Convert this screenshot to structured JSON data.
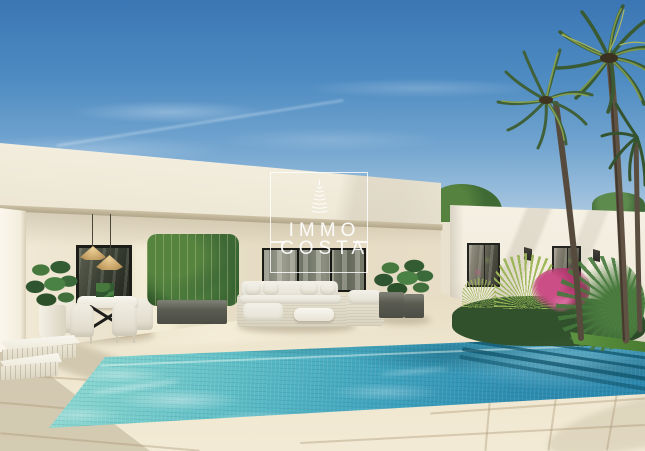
{
  "scene": {
    "setting": "3D architectural render: modern white single-storey villa with covered terrace, turquoise mosaic swimming pool, palm trees and blue sky",
    "elements": [
      "sky",
      "main-villa-fascia",
      "covered-terrace",
      "right-wing",
      "dining-set",
      "pendant-lamps",
      "outdoor-sofa",
      "bamboo-planter",
      "monstera-plant",
      "sun-loungers",
      "swimming-pool",
      "pool-steps",
      "palm-trees",
      "bougainvillea",
      "lawn",
      "stone-deck",
      "watermark"
    ]
  },
  "watermark": {
    "icon": "tower-logo-icon",
    "line1": "IMMO",
    "line2": "COSTA"
  },
  "colors": {
    "sky_top": "#3b76b4",
    "sky_horizon": "#cfdfeb",
    "facade_cream": "#f3eee1",
    "deck_beige": "#ecdfc6",
    "pool_light": "#8ed8d0",
    "pool_deep": "#2a86ac",
    "palm_green": "#3e5f37",
    "bougainvillea_pink": "#c2417d",
    "grass_green": "#55893c",
    "watermark_white": "#ffffff"
  }
}
